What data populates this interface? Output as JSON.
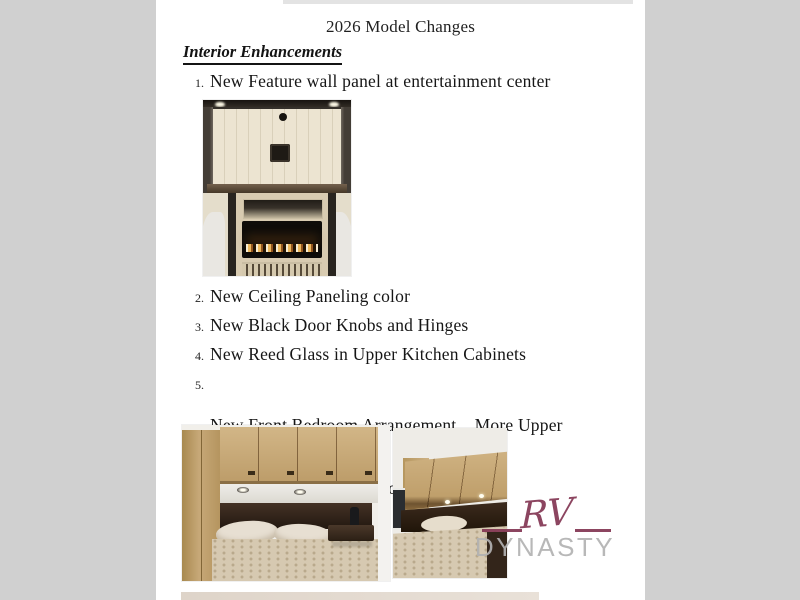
{
  "document": {
    "title": "2026 Model Changes",
    "section_heading": "Interior Enhancements",
    "items": [
      {
        "number": "1.",
        "text": "New Feature wall panel at entertainment center"
      },
      {
        "number": "2.",
        "text": "New Ceiling Paneling color"
      },
      {
        "number": "3.",
        "text": "New Black Door Knobs and Hinges"
      },
      {
        "number": "4.",
        "text": "New Reed Glass in Upper Kitchen Cabinets"
      },
      {
        "number": "5.",
        "text": "New Front Bedroom Arrangement.   More Upper",
        "text2": "Storage and Bigger Bedroom Window"
      }
    ],
    "images": [
      {
        "name": "entertainment-center-photo",
        "description": "Entertainment center with new feature wall panel, open shelf, fireplace insert and vented base"
      },
      {
        "name": "bedroom-photo-left",
        "description": "Front bedroom with wardrobe, upper storage cabinets, dark headboard and patterned bedding"
      },
      {
        "name": "bedroom-photo-right",
        "description": "Front bedroom angle showing upper cabinets, bigger bedroom window and bed"
      }
    ],
    "watermark": {
      "line1": "RV",
      "line2": "DYNASTY",
      "accent_color": "#833653",
      "text_color": "#b2b2b2"
    },
    "colors": {
      "page_background": "#ffffff",
      "margin_background": "#d0d0d0",
      "text": "#1c1c1c"
    }
  }
}
